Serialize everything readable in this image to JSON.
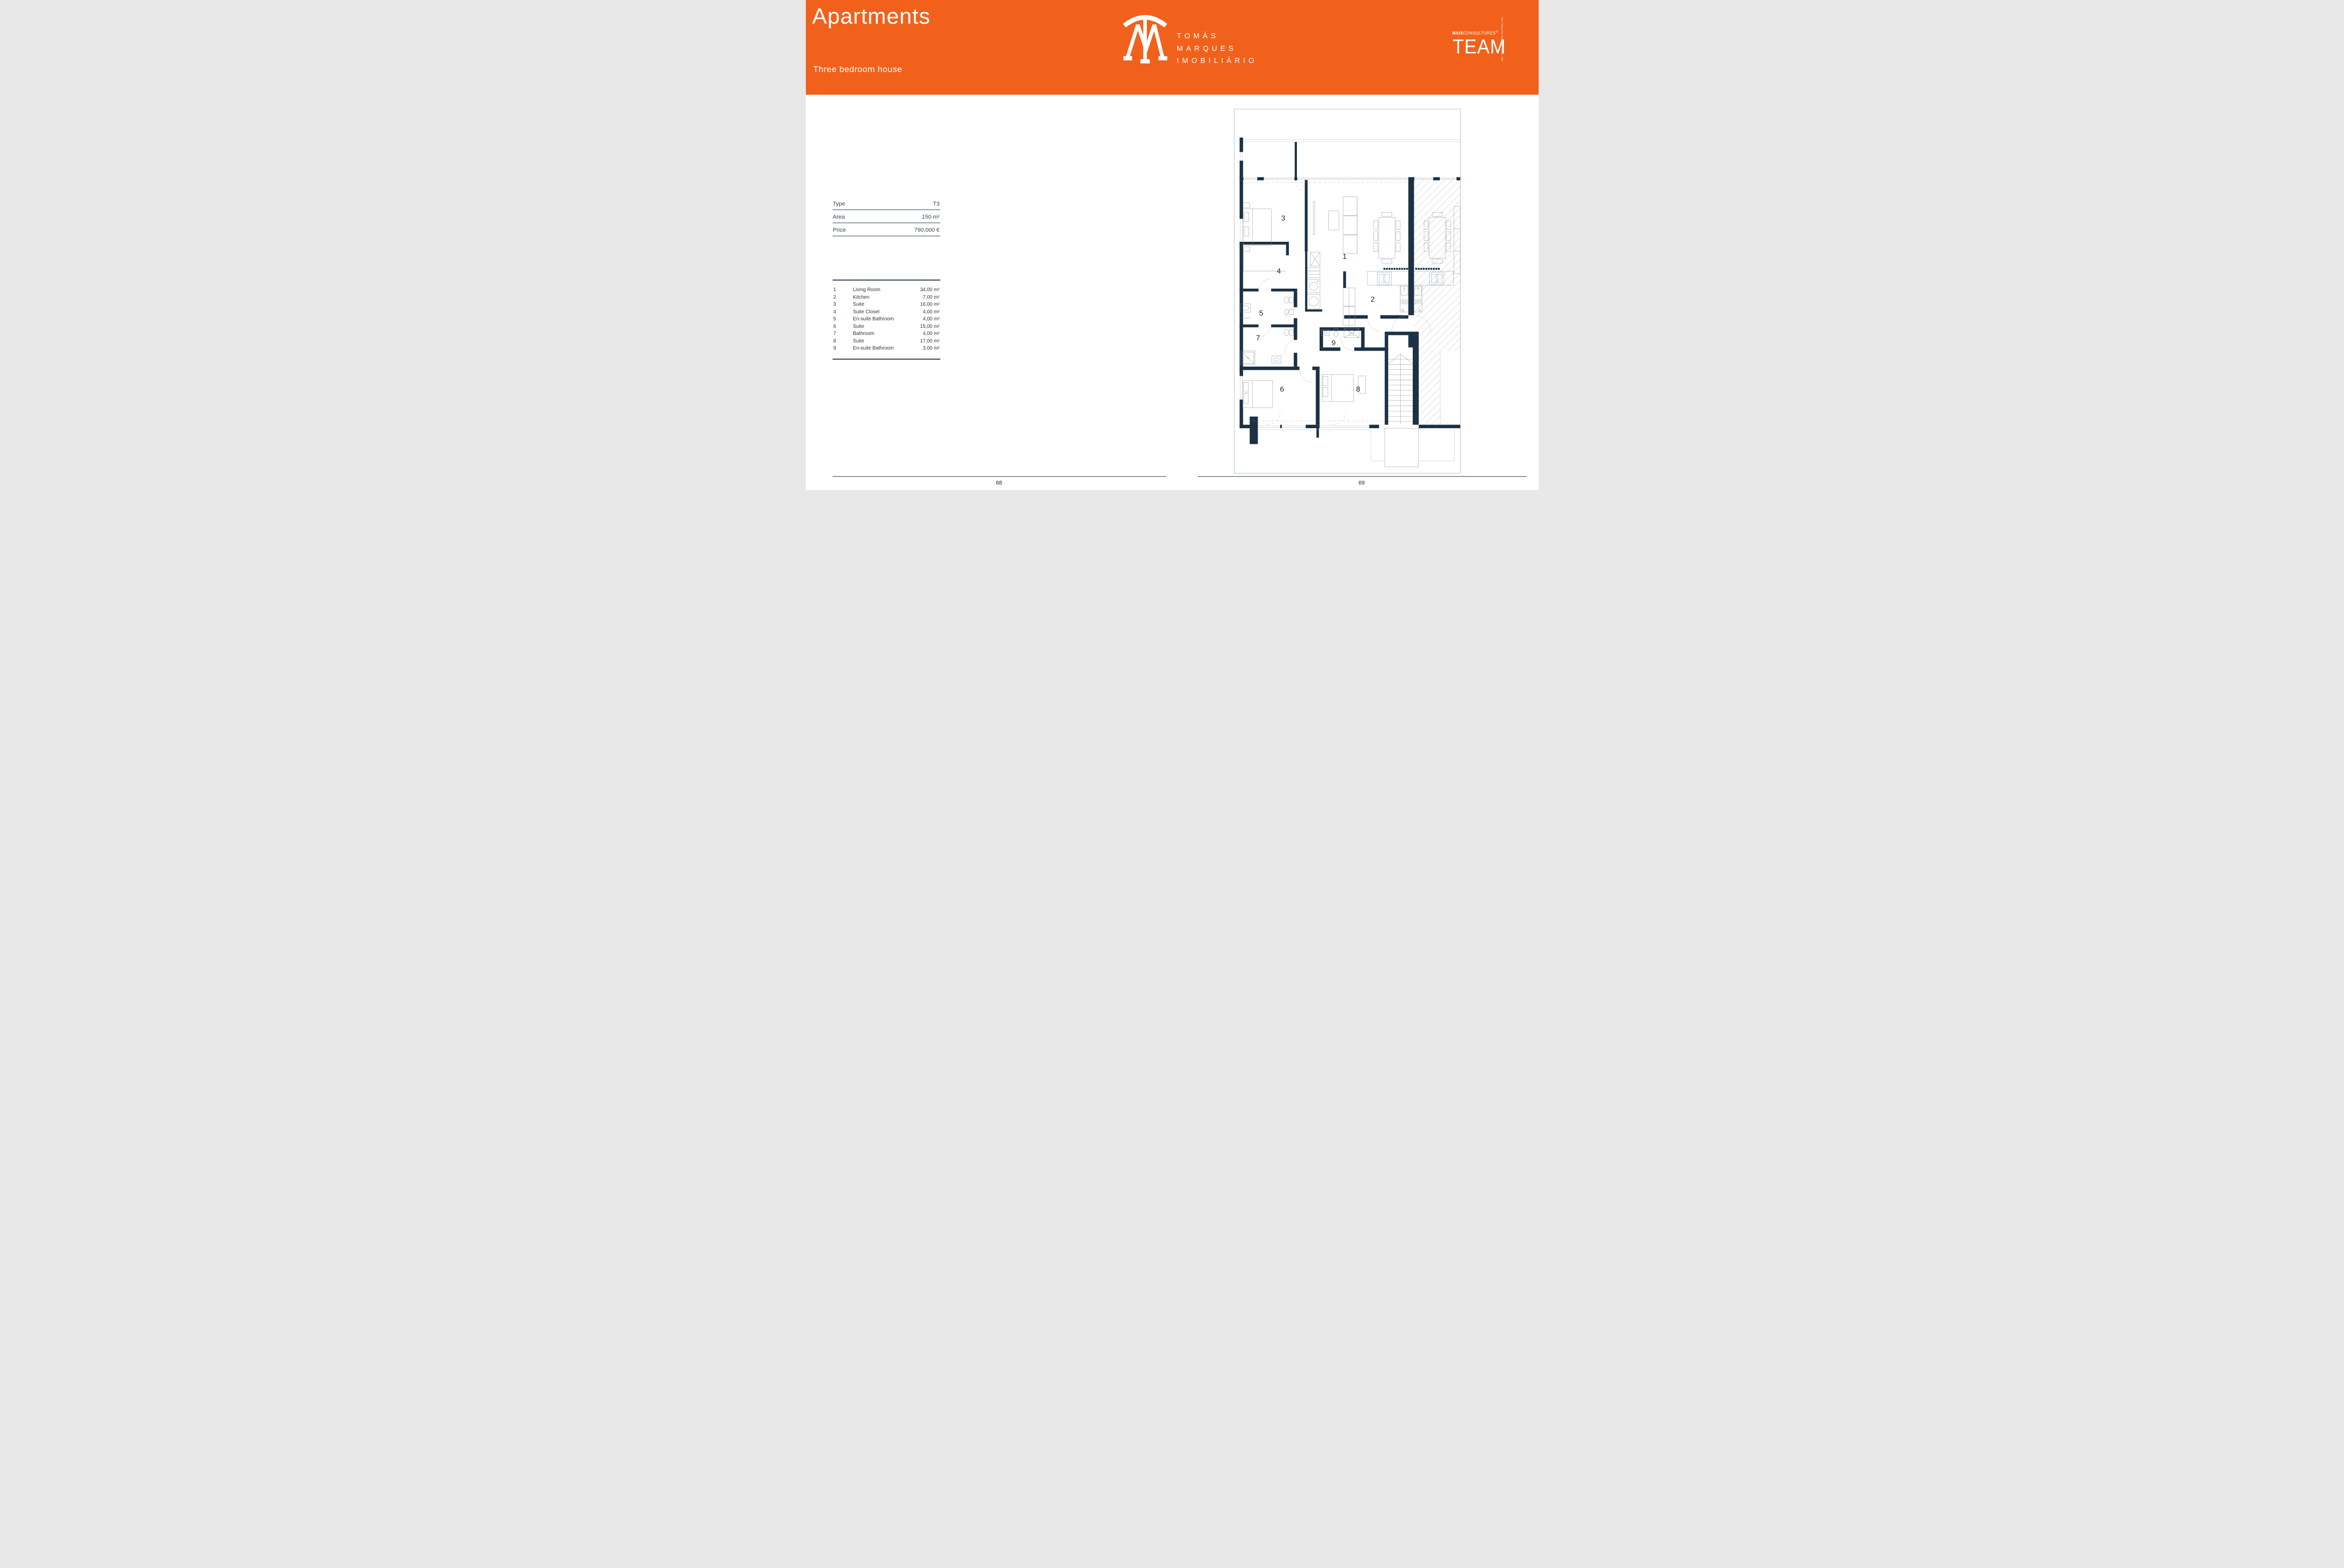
{
  "colors": {
    "accent_orange": "#F2611C",
    "wall_navy": "#1C3144",
    "line_gray": "#8D97A1"
  },
  "header": {
    "title": "Apartments",
    "subtitle": "Three bedroom house",
    "brand_lines": [
      "TOMÁS",
      "MARQUES",
      "IMOBILIÁRIO"
    ],
    "consultant": {
      "bold": "MAIS",
      "rest": "CONSULTORES",
      "reg": "®",
      "word": "TEAM",
      "side_text": "AMI: 23990   SEED THE FUTURE, LDA."
    }
  },
  "summary": {
    "rows": [
      {
        "label": "Type",
        "value": "T3"
      },
      {
        "label": "Area",
        "value": "150 m²"
      },
      {
        "label": "Price",
        "value": "790,000 €"
      }
    ]
  },
  "rooms": {
    "items": [
      {
        "num": "1",
        "name": "Living Room",
        "area": "34,00 m²"
      },
      {
        "num": "2",
        "name": "Kitchen",
        "area": "7,00 m²"
      },
      {
        "num": "3",
        "name": "Suite",
        "area": "16,00 m²"
      },
      {
        "num": "4",
        "name": "Suite Closet",
        "area": "4,00 m²"
      },
      {
        "num": "5",
        "name": "En-suite Bathroom",
        "area": "4,00 m²"
      },
      {
        "num": "6",
        "name": "Suite",
        "area": "15,00 m²"
      },
      {
        "num": "7",
        "name": "Bathroom",
        "area": "4,00 m²"
      },
      {
        "num": "8",
        "name": "Suite",
        "area": "17,00 m²"
      },
      {
        "num": "9",
        "name": "En-suite Bathroom",
        "area": "3,00 m²"
      }
    ]
  },
  "floorplan": {
    "labels": {
      "r1": "1",
      "r2": "2",
      "r3": "3",
      "r4": "4",
      "r5": "5",
      "r6": "6",
      "r7": "7",
      "r8": "8",
      "r9": "9"
    }
  },
  "footer": {
    "left_page": "68",
    "right_page": "69"
  }
}
